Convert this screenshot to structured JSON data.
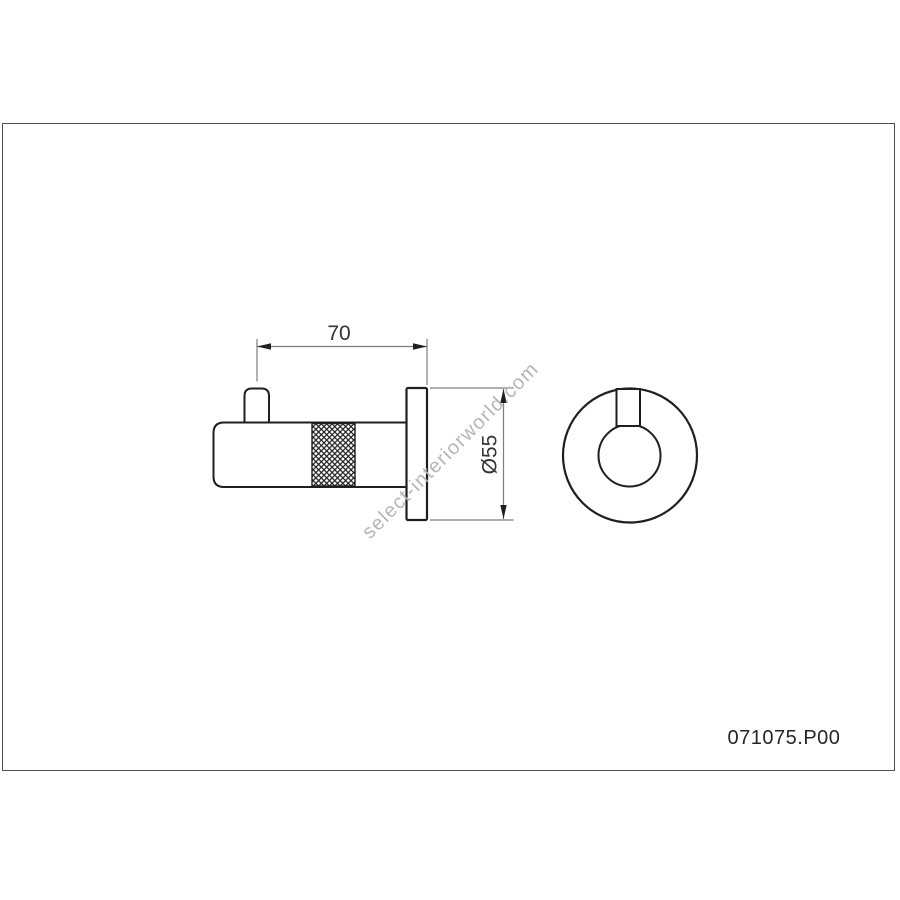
{
  "drawing": {
    "type": "technical-drawing",
    "part_number": "071075.P00",
    "watermark": "select-interiorworld.com",
    "views": {
      "side_view": "wall hook side elevation with knurled grip and wall plate",
      "front_view": "wall plate front elevation with hook peg"
    },
    "dimensions": [
      {
        "id": "projection_length",
        "label": "70"
      },
      {
        "id": "plate_diameter",
        "label": "Ø55"
      }
    ],
    "colors": {
      "outline": "#1f1f1f",
      "dimension_line": "#7d7d7d",
      "arrow": "#1f1f1f",
      "dim_text": "#333333",
      "watermark": "#b6b6b6",
      "frame_border": "#4f4f4f",
      "background": "#ffffff"
    }
  }
}
